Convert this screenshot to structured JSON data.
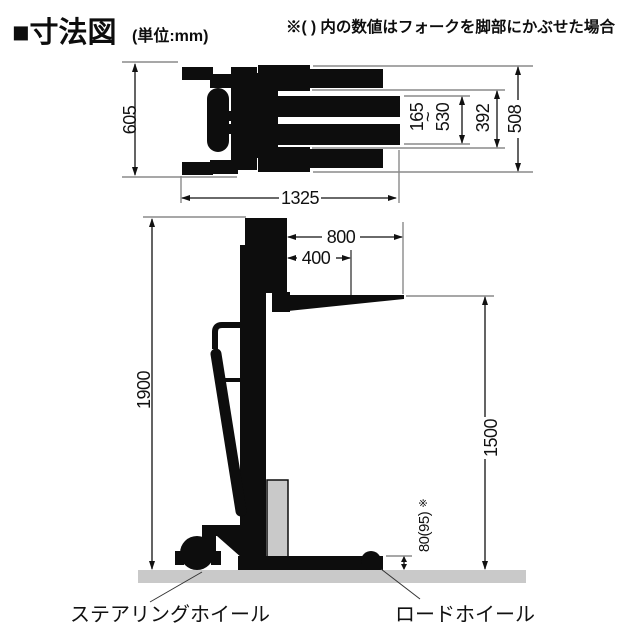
{
  "header": {
    "title": "■寸法図",
    "unit_label": "(単位:mm)",
    "note": "※( ) 内の数値はフォークを脚部にかぶせた場合"
  },
  "top_view": {
    "overall_width": "605",
    "overall_length": "1325",
    "legs_outer_width": "508",
    "legs_inner_width": "392",
    "fork_width_min": "165",
    "fork_width_tilde": "~",
    "fork_width_max": "530"
  },
  "side_view": {
    "fork_length": "800",
    "load_center": "400",
    "overall_height": "1900",
    "lift_height": "1500",
    "leg_height": "80(95)",
    "leg_height_note_mark": "※"
  },
  "part_labels": {
    "steering_wheel": "ステアリングホイール",
    "load_wheel": "ロードホイール"
  },
  "colors": {
    "ink": "#0d0d0d",
    "extension_line": "#8a8a8a",
    "ground": "#c9c9c9",
    "pump_unit": "#c9c9c9"
  }
}
